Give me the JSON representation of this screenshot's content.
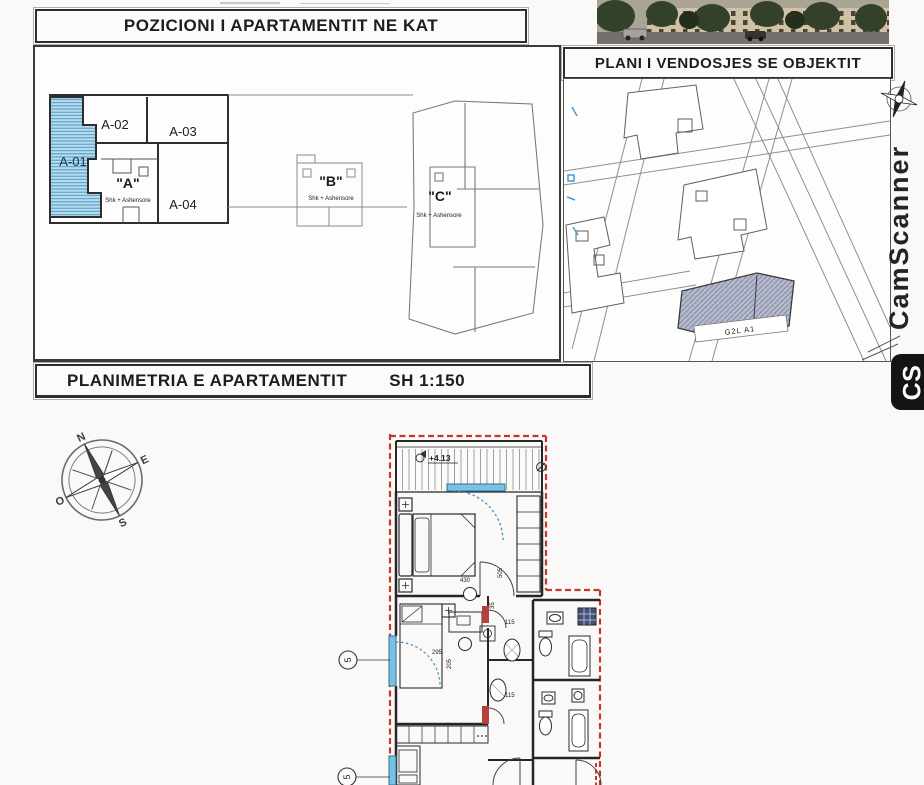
{
  "kat": {
    "title": "POZICIONI I APARTAMENTIT NE KAT",
    "a01": "A-01",
    "a02": "A-02",
    "a03": "A-03",
    "a04": "A-04",
    "coreA": "\"A\"",
    "coreB": "\"B\"",
    "coreC": "\"C\"",
    "coreSub": "Shk + Ashensore"
  },
  "site": {
    "title": "PLANI I VENDOSJES SE OBJEKTIT",
    "building_label": "G2L A1"
  },
  "plan": {
    "title": "PLANIMETRIA E APARTAMENTIT",
    "scale": "SH 1:150",
    "elevation": "+4.13",
    "d115a": "115",
    "d115b": "115",
    "d295": "295",
    "d205": "205",
    "d430": "430",
    "d505": "505",
    "d35": "35",
    "ax1": "5",
    "ax2": "5"
  },
  "compass": {
    "n": "N",
    "o": "O",
    "s": "S",
    "e": "E"
  },
  "wm": {
    "brand": "CamScanner",
    "logo": "CS"
  },
  "colors": {
    "highlight_blue": "#aed7ec",
    "boundary_red": "#c0392b",
    "window_blue": "#7bc1e4",
    "site_block_gray": "#b5bacc"
  }
}
